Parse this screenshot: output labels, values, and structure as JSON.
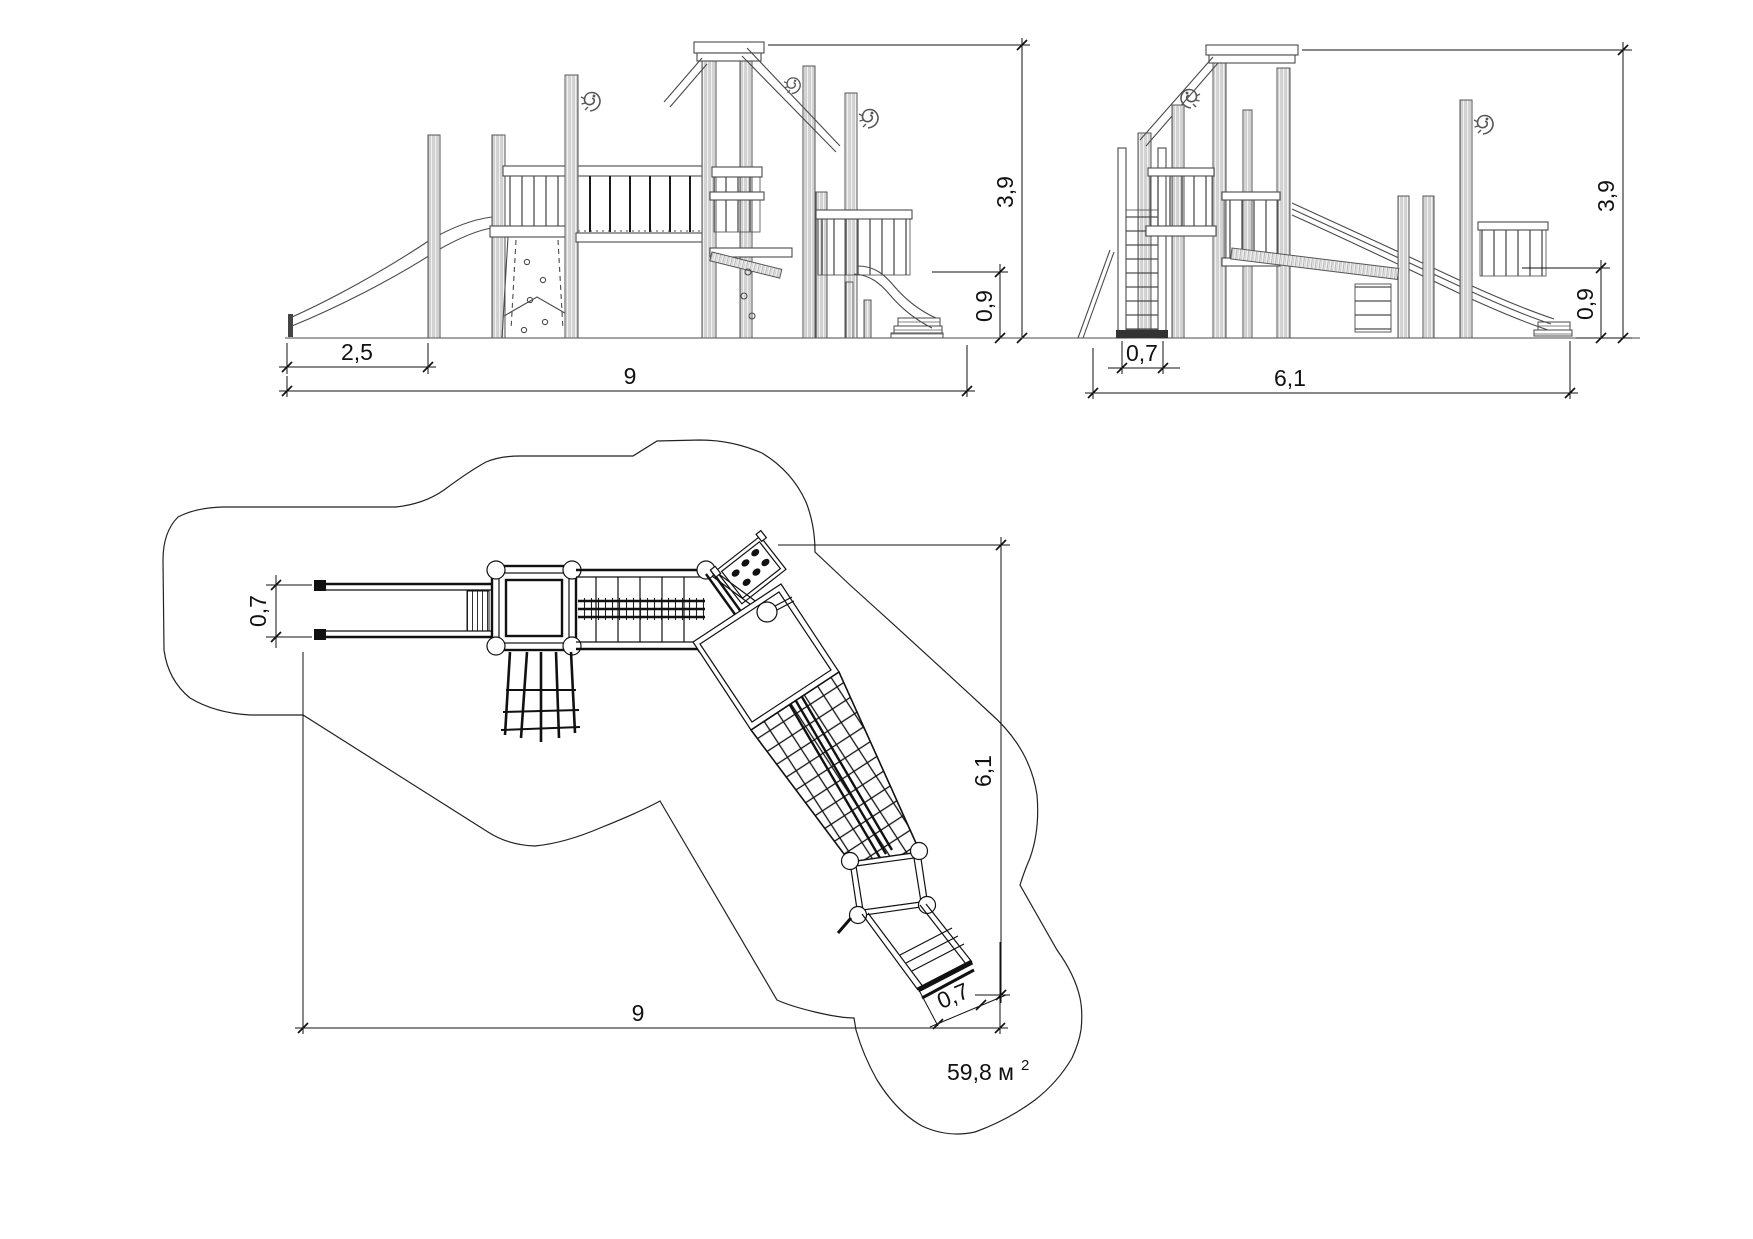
{
  "page": {
    "background_color": "#ffffff",
    "line_color": "#333333",
    "content": "playground equipment technical drawing with front elevation, side elevation and plan view of safety zone"
  },
  "views": {
    "front_elevation": {
      "name": "front-elevation",
      "dim_slide_run": "2,5",
      "dim_total_width": "9",
      "dim_total_height": "3,9",
      "dim_slide_height": "0,9"
    },
    "side_elevation": {
      "name": "side-elevation",
      "dim_ladder_width": "0,7",
      "dim_total_depth": "6,1",
      "dim_total_height": "3,9",
      "dim_slide_height": "0,9"
    },
    "plan": {
      "name": "plan-view",
      "dim_slide_width": "0,7",
      "dim_total_width": "9",
      "dim_total_depth": "6,1",
      "dim_lower_slide_width": "0,7",
      "area_value": "59,8 м",
      "area_superscript": "2"
    }
  },
  "icons": {
    "seahorse_carving": "seahorse-scroll-icon"
  }
}
